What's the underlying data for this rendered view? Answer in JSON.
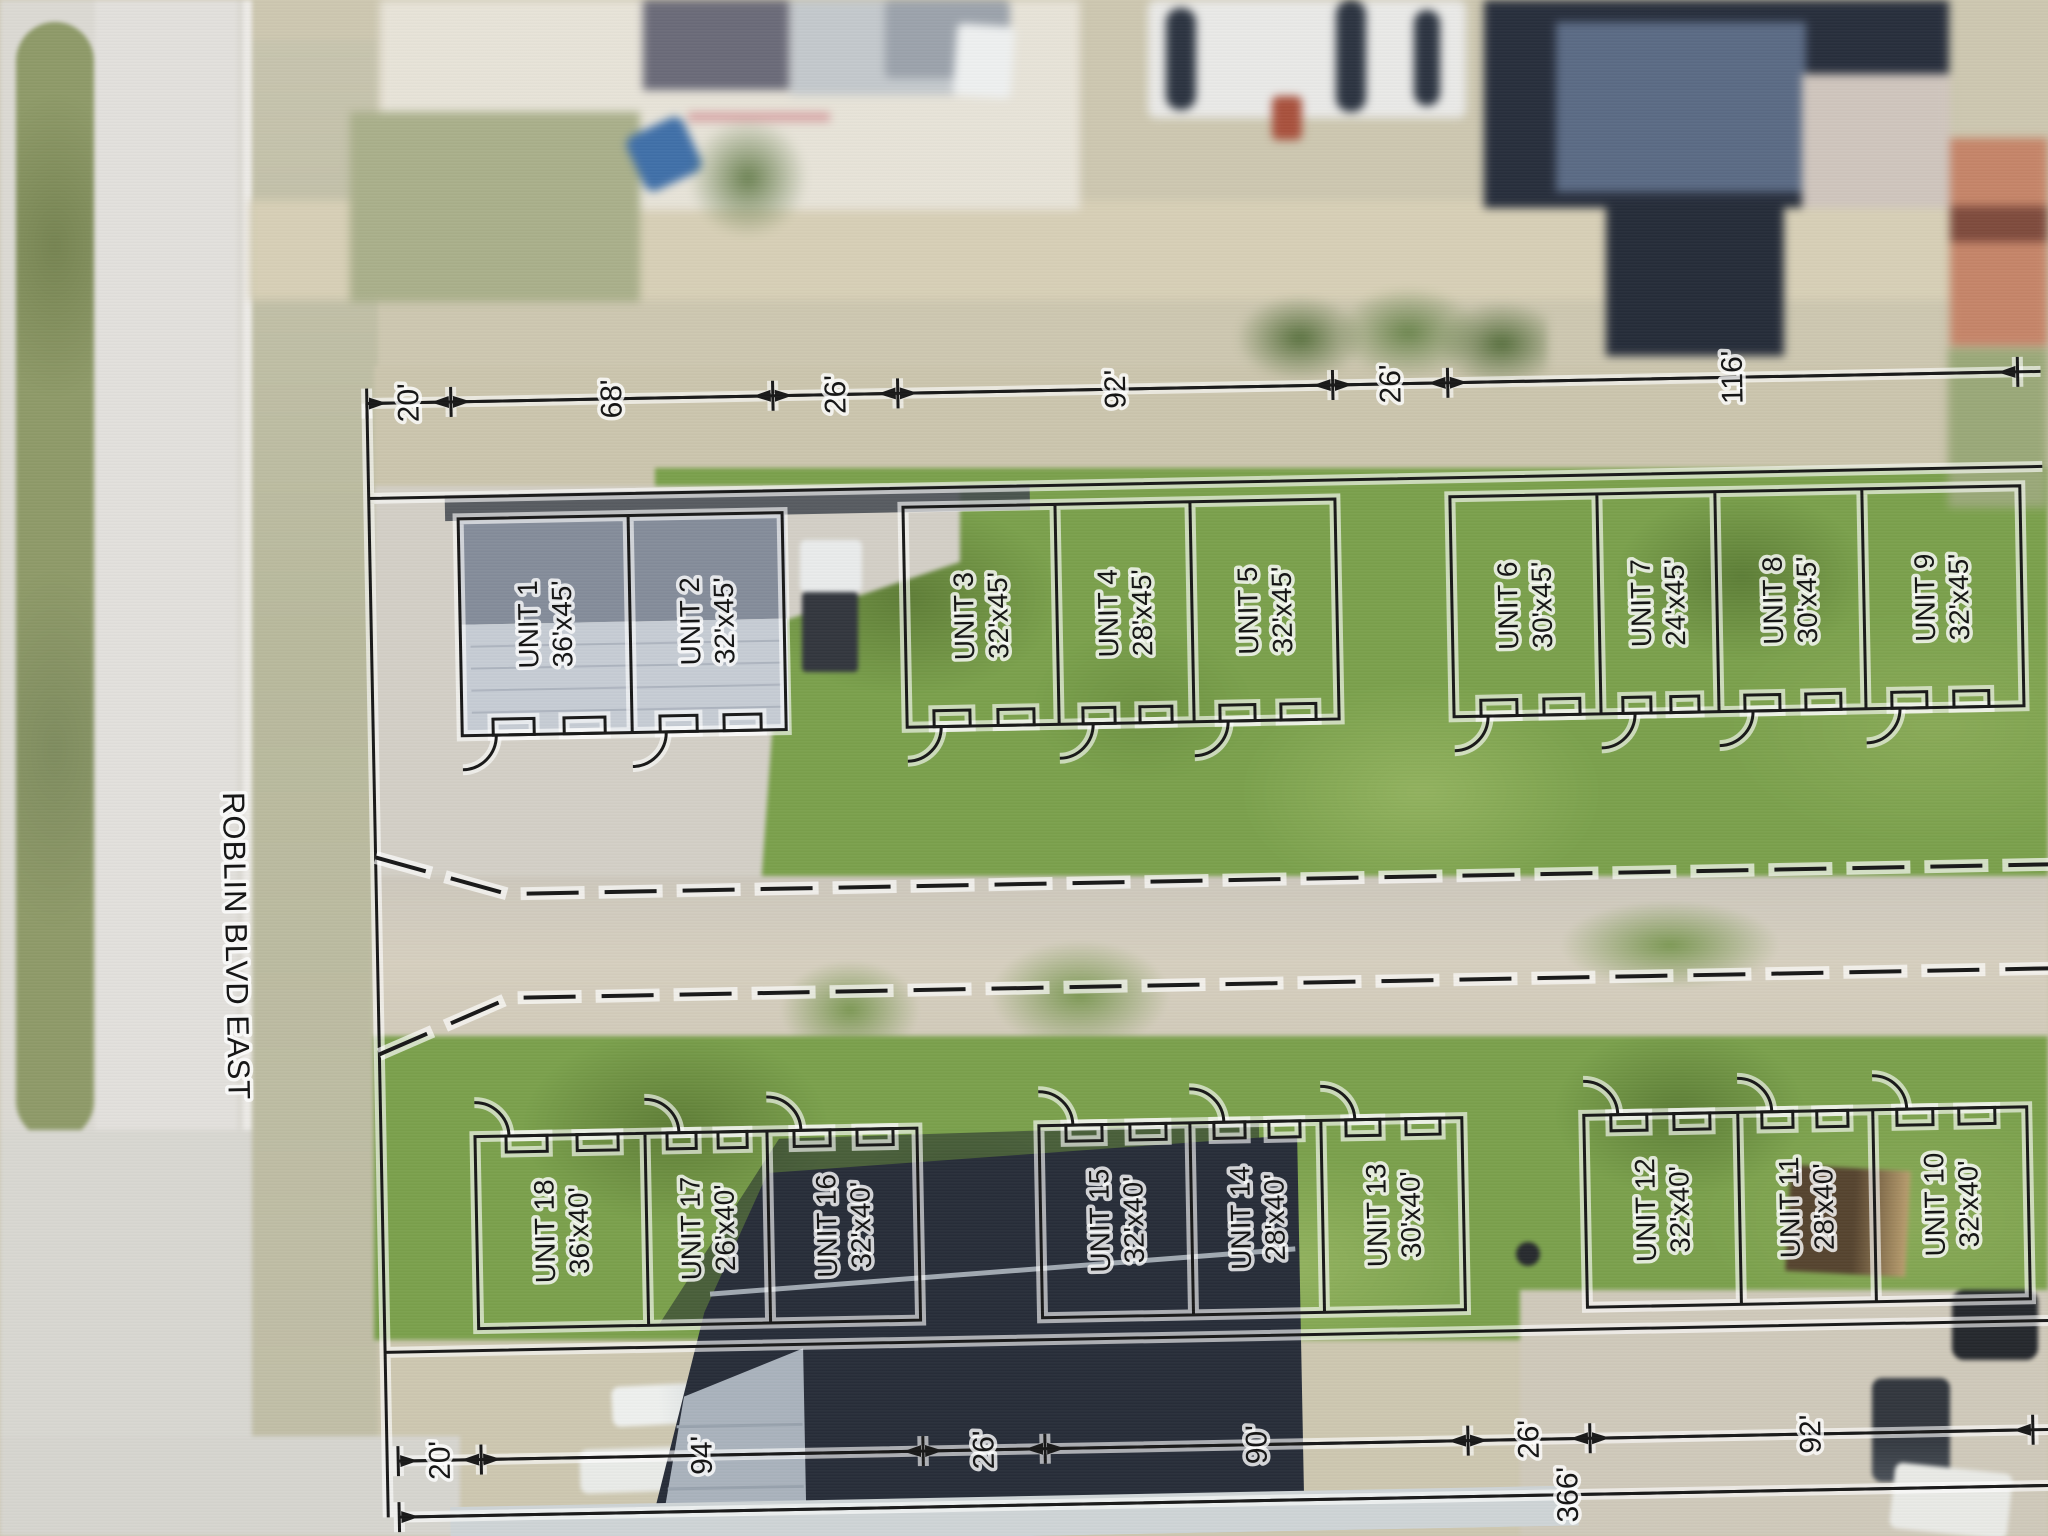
{
  "street": {
    "label": "ROBLIN BLVD EAST"
  },
  "dimensions": {
    "top": [
      "20'",
      "68'",
      "26'",
      "92'",
      "26'",
      "116'"
    ],
    "bottom": [
      "20'",
      "94'",
      "26'",
      "90'",
      "26'",
      "92'"
    ],
    "overall": "366'"
  },
  "units": [
    {
      "name": "UNIT 1",
      "size": "36'x45'"
    },
    {
      "name": "UNIT 2",
      "size": "32'x45'"
    },
    {
      "name": "UNIT 3",
      "size": "32'x45'"
    },
    {
      "name": "UNIT 4",
      "size": "28'x45'"
    },
    {
      "name": "UNIT 5",
      "size": "32'x45'"
    },
    {
      "name": "UNIT 6",
      "size": "30'x45'"
    },
    {
      "name": "UNIT 7",
      "size": "24'x45'"
    },
    {
      "name": "UNIT 8",
      "size": "30'x45'"
    },
    {
      "name": "UNIT 9",
      "size": "32'x45'"
    },
    {
      "name": "UNIT 10",
      "size": "32'x40'"
    },
    {
      "name": "UNIT 11",
      "size": "28'x40'"
    },
    {
      "name": "UNIT 12",
      "size": "32'x40'"
    },
    {
      "name": "UNIT 13",
      "size": "30'x40'"
    },
    {
      "name": "UNIT 14",
      "size": "28'x40'"
    },
    {
      "name": "UNIT 15",
      "size": "32'x40'"
    },
    {
      "name": "UNIT 16",
      "size": "32'x40'"
    },
    {
      "name": "UNIT 17",
      "size": "26'x40'"
    },
    {
      "name": "UNIT 18",
      "size": "36'x40'"
    }
  ],
  "plan": {
    "line_color": "#171717",
    "halo_color": "#ffffff"
  }
}
